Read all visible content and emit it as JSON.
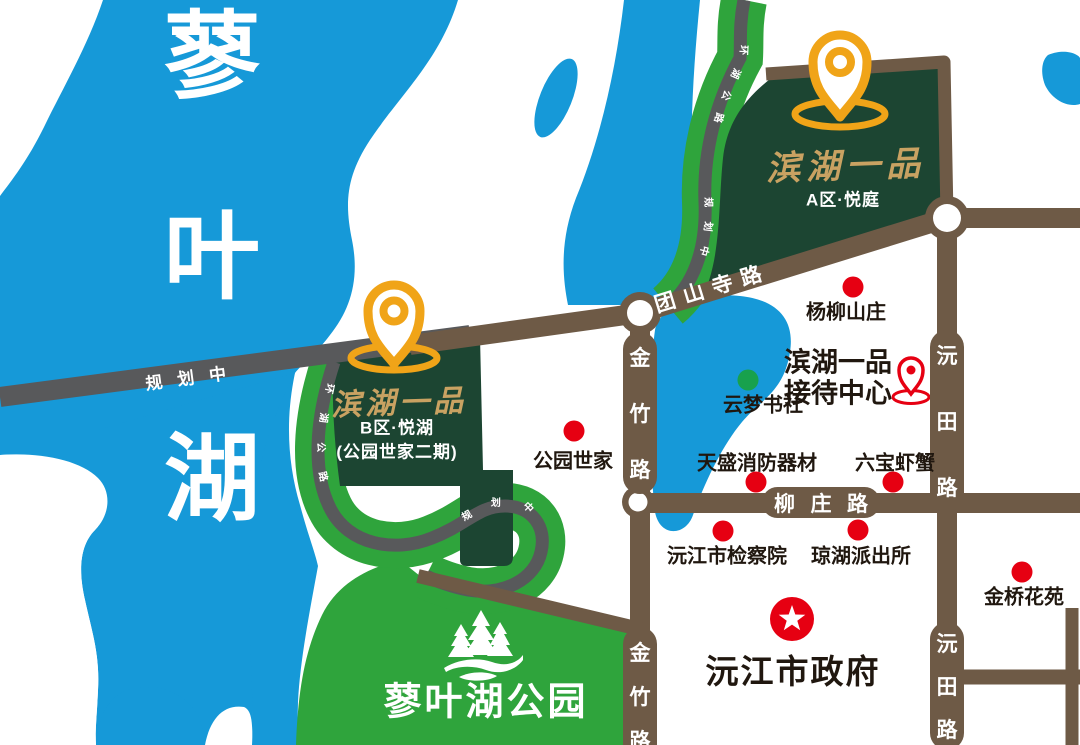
{
  "colors": {
    "lake_blue": "#1699D8",
    "park_green": "#2FA43C",
    "parcel_green": "#1C4532",
    "road_brown": "#6E5A46",
    "road_gray": "#58595B",
    "pin_gold": "#F0A418",
    "parcel_name_gold": "#C9A262",
    "poi_red": "#E60012",
    "poi_dot_green": "#18A14D"
  },
  "lake": {
    "name_chars": [
      "蓼",
      "叶",
      "湖"
    ]
  },
  "parcels": {
    "a": {
      "name": "滨湖一品",
      "subtitle": "A区·悦庭"
    },
    "b": {
      "name": "滨湖一品",
      "subtitle": "B区·悦湖",
      "subtitle2": "(公园世家二期)"
    }
  },
  "roads": {
    "tuanshansi": "团山寺路",
    "planning": "规划中",
    "ring_road": "环湖公路",
    "ring_status": "规划中",
    "jinzhu": {
      "c1": "金",
      "c2": "竹",
      "c3": "路"
    },
    "yuantian": {
      "c1": "沅",
      "c2": "田",
      "c3": "路"
    },
    "liuzhuang": {
      "c1": "柳",
      "c2": "庄",
      "c3": "路"
    }
  },
  "pois": [
    {
      "label": "杨柳山庄"
    },
    {
      "label": "云梦书社"
    },
    {
      "label": "公园世家"
    },
    {
      "label": "天盛消防器材"
    },
    {
      "label": "六宝虾蟹"
    },
    {
      "label": "沅江市检察院"
    },
    {
      "label": "琼湖派出所"
    },
    {
      "label": "金桥花苑"
    }
  ],
  "reception": {
    "line1": "滨湖一品",
    "line2": "接待中心"
  },
  "government": {
    "label": "沅江市政府"
  },
  "park": {
    "label": "蓼叶湖公园"
  }
}
